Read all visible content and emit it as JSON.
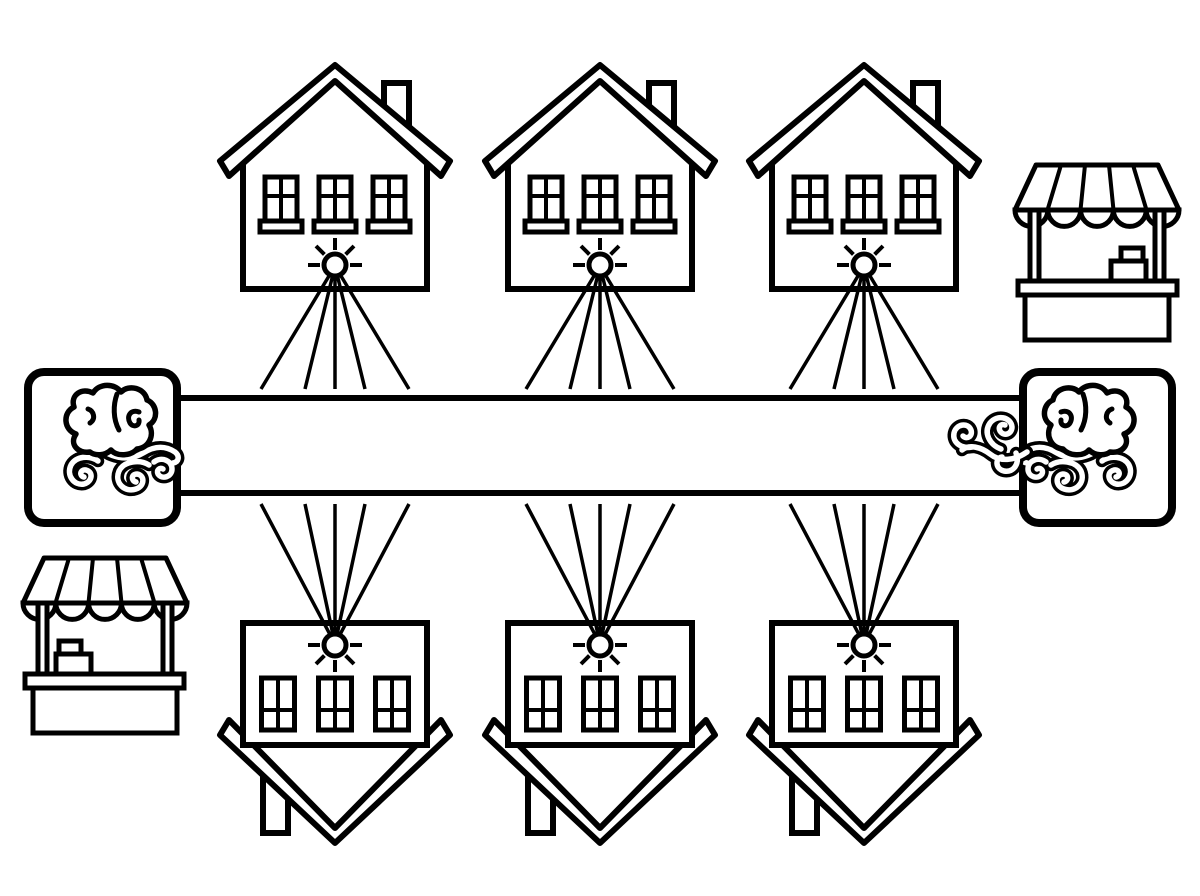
{
  "scene": {
    "background": "#ffffff",
    "ink": "#000000",
    "width": 1200,
    "height": 896
  },
  "rows": {
    "top_houses": {
      "icon": "house-icon",
      "count": 3,
      "centers_x": [
        335,
        600,
        864
      ],
      "rays_each": 5,
      "ray_direction": "down"
    },
    "bottom_houses": {
      "icon": "inverted-house-icon",
      "count": 3,
      "centers_x": [
        335,
        600,
        864
      ],
      "rays_each": 5,
      "ray_direction": "up"
    }
  },
  "bar": {
    "x": 177,
    "y": 398,
    "width": 846,
    "height": 95
  },
  "brain_boxes": [
    {
      "side": "left",
      "icon": "brain-icon"
    },
    {
      "side": "right",
      "icon": "brain-icon"
    }
  ],
  "stalls": [
    {
      "position": "top-right",
      "icon": "market-stall-icon",
      "register_side": "right"
    },
    {
      "position": "bottom-left",
      "icon": "market-stall-icon",
      "register_side": "left"
    }
  ]
}
